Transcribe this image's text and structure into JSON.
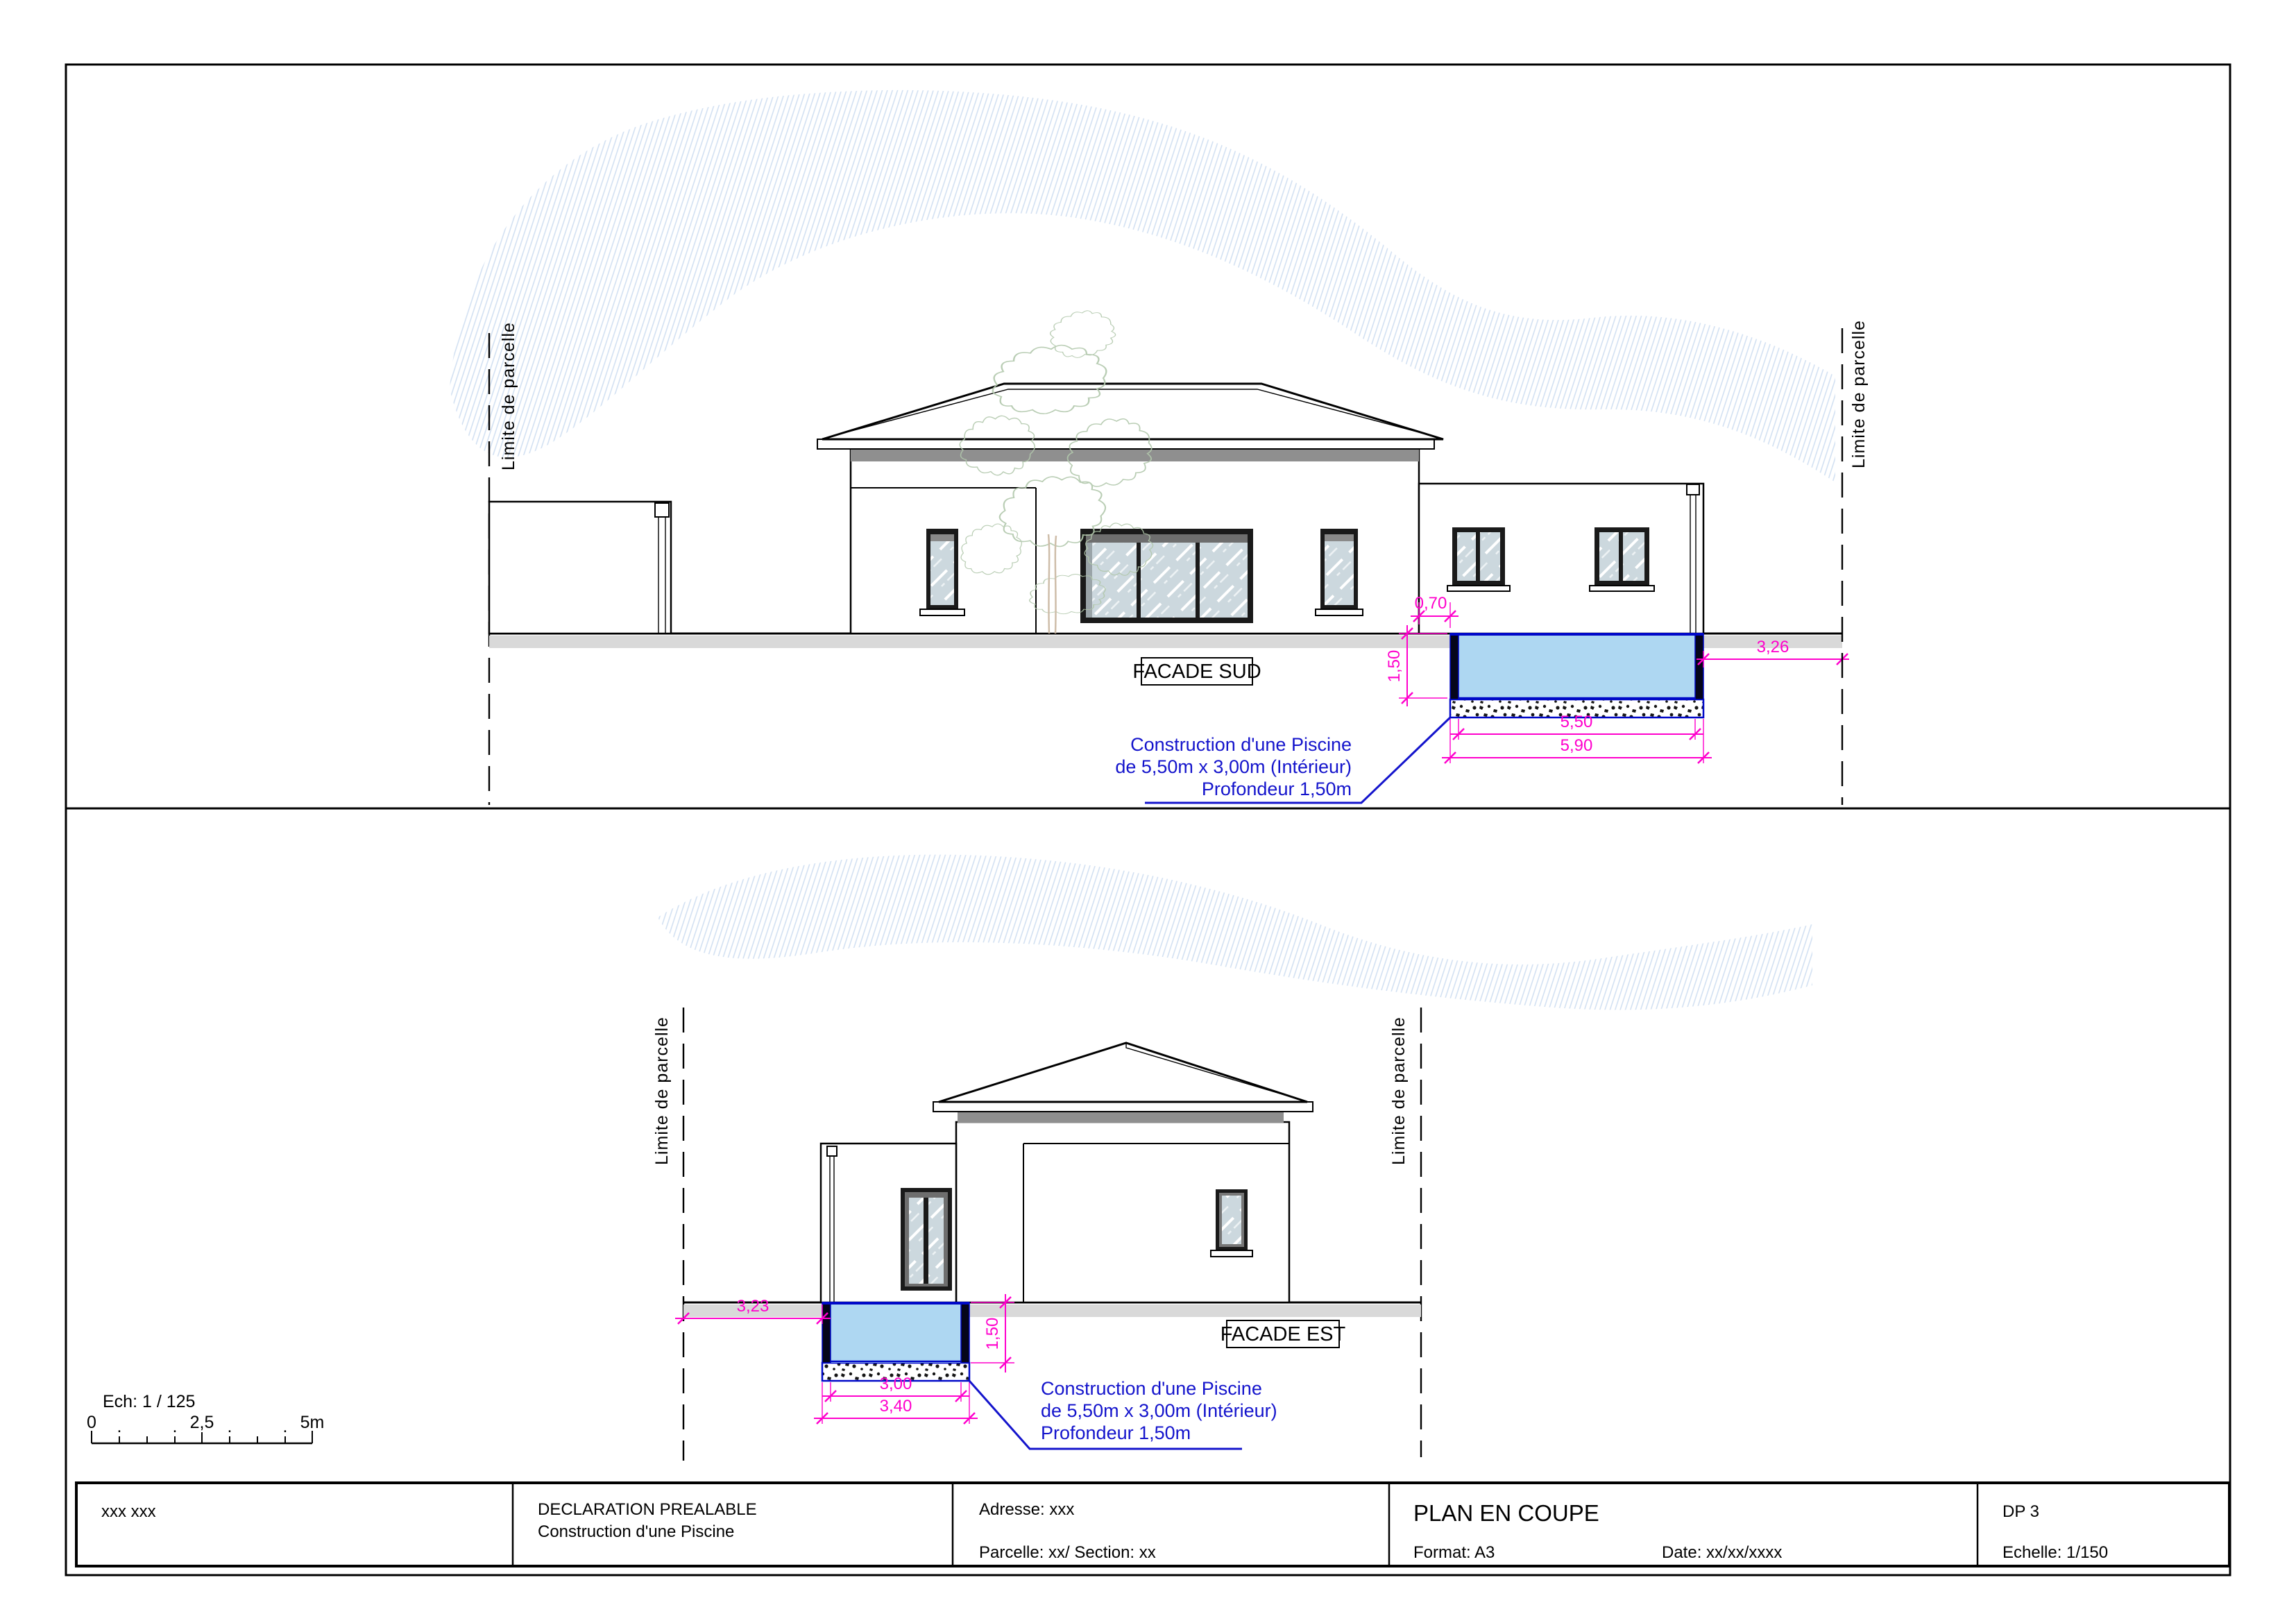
{
  "facade_sud": {
    "label": "FACADE SUD",
    "parcel_limit_left": "Limite de parcelle",
    "parcel_limit_right": "Limite de parcelle",
    "dimensions": {
      "house_offset_m": "0,70",
      "depth_m": "1,50",
      "distance_to_limit_m": "3,26",
      "pool_interior_length_m": "5,50",
      "pool_exterior_length_m": "5,90"
    },
    "annotation": [
      "Construction d'une Piscine",
      "de 5,50m x 3,00m (Intérieur)",
      "Profondeur 1,50m"
    ]
  },
  "facade_est": {
    "label": "FACADE EST",
    "parcel_limit_left": "Limite de parcelle",
    "parcel_limit_right": "Limite de parcelle",
    "dimensions": {
      "distance_to_limit_m": "3,23",
      "depth_m": "1,50",
      "pool_interior_width_m": "3,00",
      "pool_exterior_width_m": "3,40"
    },
    "annotation": [
      "Construction d'une Piscine",
      "de 5,50m x 3,00m (Intérieur)",
      "Profondeur 1,50m"
    ]
  },
  "scale_bar": {
    "label": "Ech: 1 / 125",
    "tick_start": "0",
    "tick_mid": "2,5",
    "tick_end": "5m",
    "dot": "."
  },
  "title_block": {
    "author": "xxx xxx",
    "procedure_title": "DECLARATION PREALABLE",
    "procedure_subtitle": "Construction d'une Piscine",
    "address": "Adresse: xxx",
    "parcel": "Parcelle: xx/ Section: xx",
    "sheet_title": "PLAN EN COUPE",
    "format": "Format: A3",
    "date": "Date: xx/xx/xxxx",
    "sheet_number": "DP 3",
    "scale": "Echelle: 1/150"
  },
  "colors": {
    "dimension_magenta": "#FF00CC",
    "annotation_blue": "#1414CC",
    "pool_water": "#AED7F2",
    "pool_structure": "#05051A",
    "pool_outline": "#0008C8",
    "ground_gray": "#D9D9D9",
    "eave_shadow_gray": "#8F8F8F",
    "roof_tile": "#D79B84",
    "roof_tile_fill": "#FAF0EA",
    "tree_green": "#B2C8AC",
    "trunk_brown": "#C9B6A0",
    "sky_hatch_blue": "#C6D8EE",
    "glass_blue": "#CCD8DE"
  }
}
